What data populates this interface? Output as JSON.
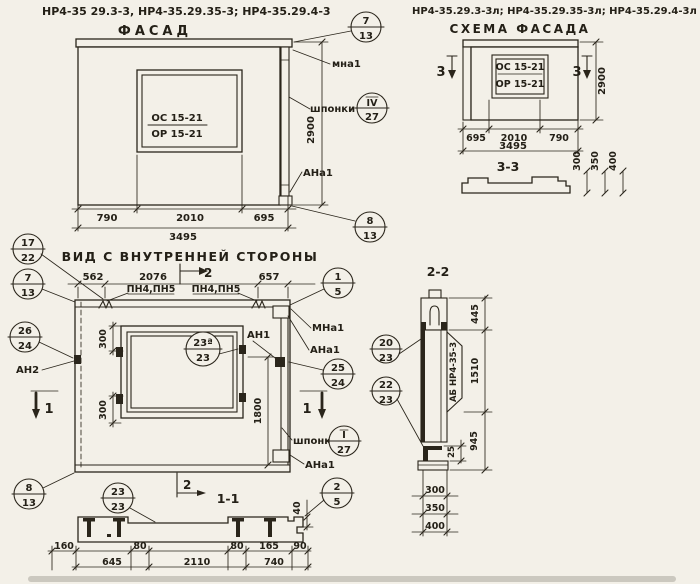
{
  "facade": {
    "codes": "НР4-35 29.3-3, НР4-35.29.35-3; НР4-35.29.4-3",
    "title": "ФАСАД",
    "window_top": "ОС 15-21",
    "window_bottom": "ОР 15-21",
    "label_mna": "мна1",
    "label_shponki": "шпонки",
    "label_ana": "АНа1",
    "dim_height": "2900",
    "dim_left": "790",
    "dim_mid": "2010",
    "dim_right": "695",
    "dim_total": "3495",
    "callout_top": {
      "num": "7",
      "den": "13"
    },
    "callout_key": {
      "num": "IV",
      "den": "27"
    },
    "callout_bottom": {
      "num": "8",
      "den": "13"
    }
  },
  "scheme": {
    "codes": "НР4-35.29.3-3л; НР4-35.29.35-3л; НР4-35.29.4-3л",
    "title": "СХЕМА ФАСАДА",
    "window_top": "ОС 15-21",
    "window_bottom": "ОР 15-21",
    "mark": "3",
    "dim_height": "2900",
    "dim_left": "695",
    "dim_mid": "2010",
    "dim_right": "790",
    "dim_total": "3495",
    "section_title": "3-3",
    "step_dims": [
      "300",
      "350",
      "400"
    ]
  },
  "inner": {
    "title": "ВИД С ВНУТРЕННЕЙ СТОРОНЫ",
    "dim_top_left": "562",
    "dim_top_mid": "2076",
    "dim_top_right": "657",
    "pn_label_1": "ПН4,ПН5",
    "pn_label_2": "ПН4,ПН5",
    "arrow_top": "2",
    "arrow_bottom": "2",
    "mark": "1",
    "label_mna": "МНа1",
    "label_ana_top": "АНа1",
    "label_an1": "АН1",
    "label_an2": "АН2",
    "label_shponki": "шпонки",
    "label_ana_bottom": "АНа1",
    "dim_300a": "300",
    "dim_300b": "300",
    "dim_1800": "1800",
    "callout_17_22": {
      "num": "17",
      "den": "22"
    },
    "callout_7_13": {
      "num": "7",
      "den": "13"
    },
    "callout_1_5": {
      "num": "1",
      "den": "5"
    },
    "callout_26_24": {
      "num": "26",
      "den": "24"
    },
    "callout_25_24": {
      "num": "25",
      "den": "24"
    },
    "callout_key": {
      "num": "I",
      "den": "27"
    },
    "callout_window": {
      "num": "23ª",
      "den": "23"
    },
    "callout_8_13": {
      "num": "8",
      "den": "13"
    }
  },
  "section11": {
    "title": "1-1",
    "callout_23_23": {
      "num": "23",
      "den": "23"
    },
    "callout_2_5": {
      "num": "2",
      "den": "5"
    },
    "dim_40": "40",
    "row1": [
      "160",
      "80",
      "80",
      "165",
      "90"
    ],
    "row2": [
      "645",
      "2110",
      "740"
    ]
  },
  "section22": {
    "title": "2-2",
    "vertical_label": "АБ НР4-35-3",
    "callout_20_23": {
      "num": "20",
      "den": "23"
    },
    "callout_22_23": {
      "num": "22",
      "den": "23"
    },
    "dim_445": "445",
    "dim_1510": "1510",
    "dim_25": "25",
    "dim_945": "945",
    "step_dims": [
      "300",
      "350",
      "400"
    ]
  }
}
